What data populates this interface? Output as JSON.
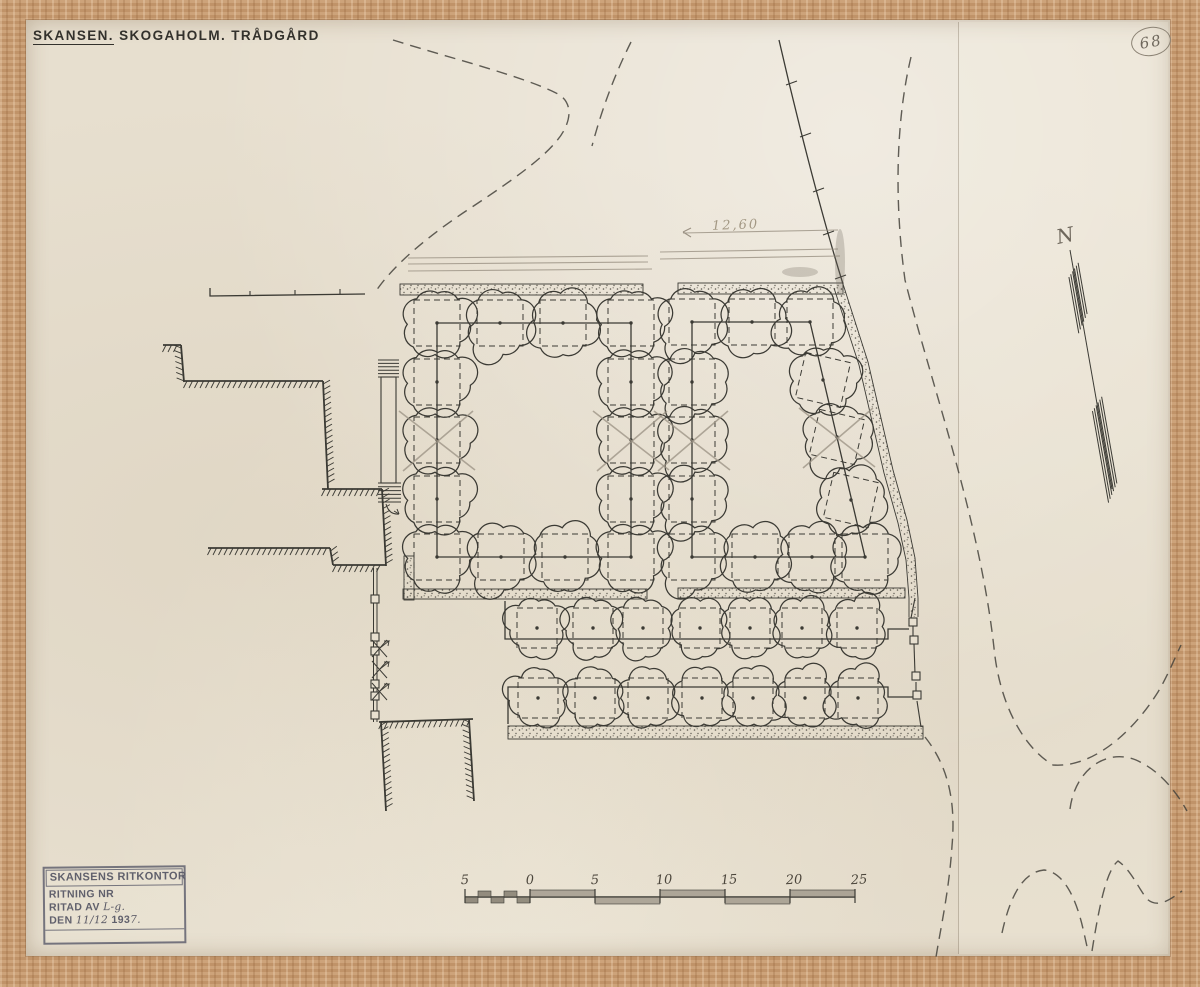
{
  "title": {
    "main": "SKANSEN.",
    "rest": "SKOGAHOLM. TRÅDGÅRD"
  },
  "plan_number": "68",
  "north_label": "N",
  "dimension_note": "12,60",
  "stamp": {
    "office": "SKANSENS RITKONTOR",
    "row1_label": "RITNING NR",
    "row2_label": "RITAD AV",
    "row2_value": "L-g.",
    "row3_label": "DEN",
    "row3_value_a": "11/12",
    "row3_value_b": "193",
    "row3_value_c": "7."
  },
  "scale_bar": {
    "labels": [
      "5",
      "0",
      "5",
      "10",
      "15",
      "20",
      "25"
    ]
  },
  "colors": {
    "ink": "#3b3a34",
    "pencil": "#9a9183",
    "pencil_dark": "#6e675c",
    "stamp_ink": "#60606c",
    "paper": "#e7dfcf",
    "frame_wood": "#c79a6f"
  },
  "drawing": {
    "bands": [
      {
        "x": 400,
        "y": 284,
        "w": 243,
        "h": 11
      },
      {
        "x": 678,
        "y": 283,
        "w": 165,
        "h": 11
      },
      {
        "x": 403,
        "y": 589,
        "w": 244,
        "h": 10
      },
      {
        "x": 678,
        "y": 588,
        "w": 227,
        "h": 10
      },
      {
        "x": 508,
        "y": 726,
        "w": 415,
        "h": 13
      },
      {
        "x": 404,
        "y": 556,
        "w": 10,
        "h": 44
      }
    ],
    "diag_band": {
      "mid": "M 839,286 L 864,363 L 889,471 L 903,521 L 911,559 L 914,598 L 914,617",
      "edges": [
        "M 843,284 L 868,362 L 893,470 L 907,520 L 915,558 L 918,598 L 918,617",
        "M 834,288 L 859,365 L 884,473 L 898,523 L 906,560 L 909,598 L 909,617"
      ],
      "w": 8
    },
    "ink_paths": [
      "M 437,323 L 631,323 L 631,557 L 437,557 Z",
      "M 692,322 L 810,322 L 865,557 L 692,557 Z",
      "M 505,601 L 505,639 L 888,639 L 888,629 L 909,629",
      "M 508,724 L 508,687 L 888,687 L 888,697 L 914,697",
      "M 210,288 L 210,296 L 365,294",
      "M 779,40 C 795,110 820,210 843,284"
    ],
    "ink_lines": [
      [
        786,
        85,
        797,
        81
      ],
      [
        800,
        137,
        811,
        133
      ],
      [
        813,
        192,
        824,
        188
      ],
      [
        823,
        235,
        834,
        231
      ],
      [
        835,
        279,
        846,
        275
      ],
      [
        250,
        291,
        250,
        296
      ],
      [
        295,
        290,
        295,
        295
      ],
      [
        340,
        289,
        340,
        294
      ],
      [
        915,
        598,
        911,
        618
      ],
      [
        913,
        626,
        913,
        636
      ],
      [
        914,
        644,
        915,
        674
      ],
      [
        916,
        682,
        916,
        693
      ],
      [
        917,
        701,
        921,
        727
      ]
    ],
    "fence_main": {
      "x": 375,
      "y1": 568,
      "y2": 722
    },
    "posts": [
      [
        371,
        595
      ],
      [
        371,
        633
      ],
      [
        371,
        647
      ],
      [
        371,
        680
      ],
      [
        371,
        692
      ],
      [
        371,
        711
      ],
      [
        909,
        618
      ],
      [
        910,
        636
      ],
      [
        912,
        672
      ],
      [
        913,
        691
      ]
    ],
    "gates": [
      {
        "x": 372,
        "y": 640
      },
      {
        "x": 372,
        "y": 661
      },
      {
        "x": 372,
        "y": 683
      }
    ],
    "stairs": {
      "box": [
        381,
        377,
        15,
        106
      ],
      "rungs_top": [
        378,
        399,
        360,
        377,
        6
      ],
      "rungs_bot": [
        378,
        401,
        483,
        502,
        6
      ]
    },
    "arrow_curve": "M 386,504 Q 389,515 399,514",
    "roads": [
      "M 393,40 C 450,58 522,76 556,93 C 569,99 572,112 566,126 C 557,149 519,176 469,209 C 434,232 394,263 374,294",
      "M 631,42 C 616,72 603,105 592,146",
      "M 911,57 C 896,120 894,200 905,280 C 930,380 980,520 994,648 C 999,700 1021,746 1053,765 C 1091,768 1131,735 1158,692 C 1167,677 1174,660 1181,645",
      "M 925,737 C 948,766 956,801 952,846 C 949,891 941,926 936,957",
      "M 1070,809 C 1075,770 1106,748 1136,760 C 1159,770 1176,791 1187,811",
      "M 1002,933 C 1010,896 1023,872 1044,870 C 1063,872 1076,896 1084,933 L 1088,951",
      "M 1092,951 C 1100,901 1107,870 1118,861 C 1131,870 1137,886 1147,899 C 1158,909 1171,899 1182,891"
    ],
    "pencil_lines": [
      [
        408,
        258,
        648,
        256
      ],
      [
        408,
        264,
        648,
        262
      ],
      [
        408,
        271,
        652,
        269
      ],
      [
        660,
        252,
        838,
        249
      ],
      [
        660,
        259,
        840,
        256
      ],
      [
        683,
        233,
        838,
        230
      ]
    ],
    "pencil_arrow": [
      [
        683,
        232,
        691,
        228
      ],
      [
        683,
        232,
        691,
        237
      ]
    ],
    "smudges": [
      [
        840,
        262,
        5,
        33
      ],
      [
        800,
        272,
        18,
        5
      ]
    ],
    "walls": [
      [
        163,
        345,
        181,
        345,
        1
      ],
      [
        181,
        345,
        184,
        382,
        1
      ],
      [
        184,
        381,
        323,
        381,
        1
      ],
      [
        323,
        381,
        328,
        489,
        -1
      ],
      [
        322,
        489,
        382,
        489,
        1
      ],
      [
        382,
        489,
        386,
        566,
        -1
      ],
      [
        208,
        548,
        330,
        548,
        1
      ],
      [
        330,
        548,
        333,
        565,
        -1
      ],
      [
        333,
        565,
        386,
        565,
        1
      ],
      [
        379,
        722,
        473,
        719,
        1
      ],
      [
        381,
        722,
        386,
        811,
        -1
      ],
      [
        469,
        719,
        474,
        801,
        1
      ]
    ],
    "trees": [
      {
        "r": 33,
        "sq": 46,
        "rot": 0,
        "pts": [
          [
            437,
            323
          ],
          [
            500,
            323
          ],
          [
            563,
            323
          ],
          [
            631,
            323
          ],
          [
            437,
            382
          ],
          [
            437,
            440
          ],
          [
            437,
            499
          ],
          [
            631,
            382
          ],
          [
            631,
            440
          ],
          [
            631,
            499
          ],
          [
            437,
            557
          ],
          [
            501,
            557
          ],
          [
            565,
            557
          ],
          [
            631,
            557
          ]
        ]
      },
      {
        "r": 33,
        "sq": 46,
        "rot": 0,
        "pts": [
          [
            692,
            322
          ],
          [
            752,
            322
          ],
          [
            810,
            322
          ],
          [
            692,
            382
          ],
          [
            692,
            440
          ],
          [
            692,
            499
          ],
          [
            692,
            557
          ],
          [
            755,
            557
          ],
          [
            812,
            557
          ],
          [
            865,
            557
          ]
        ]
      },
      {
        "r": 33,
        "sq": 46,
        "rot": 13,
        "pts": [
          [
            823,
            380
          ],
          [
            837,
            437
          ],
          [
            851,
            500
          ]
        ]
      },
      {
        "r": 28,
        "sq": 40,
        "rot": 0,
        "pts": [
          [
            537,
            628
          ],
          [
            593,
            628
          ],
          [
            643,
            628
          ],
          [
            700,
            628
          ],
          [
            750,
            628
          ],
          [
            802,
            628
          ],
          [
            857,
            628
          ],
          [
            538,
            698
          ],
          [
            595,
            698
          ],
          [
            648,
            698
          ],
          [
            702,
            698
          ],
          [
            753,
            698
          ],
          [
            805,
            698
          ],
          [
            858,
            698
          ]
        ]
      }
    ],
    "crossed": [
      [
        437,
        440
      ],
      [
        631,
        440
      ],
      [
        692,
        440
      ],
      [
        837,
        437
      ]
    ],
    "north": {
      "x1": 1070,
      "y1": 250,
      "x2": 1112,
      "y2": 489,
      "clusters": [
        [
          14,
          66
        ],
        [
          150,
          238
        ]
      ]
    },
    "scale": {
      "y": 897,
      "x_left": 465,
      "x_zero": 530,
      "unit": 65,
      "n": 5,
      "tick_h": 12
    }
  }
}
